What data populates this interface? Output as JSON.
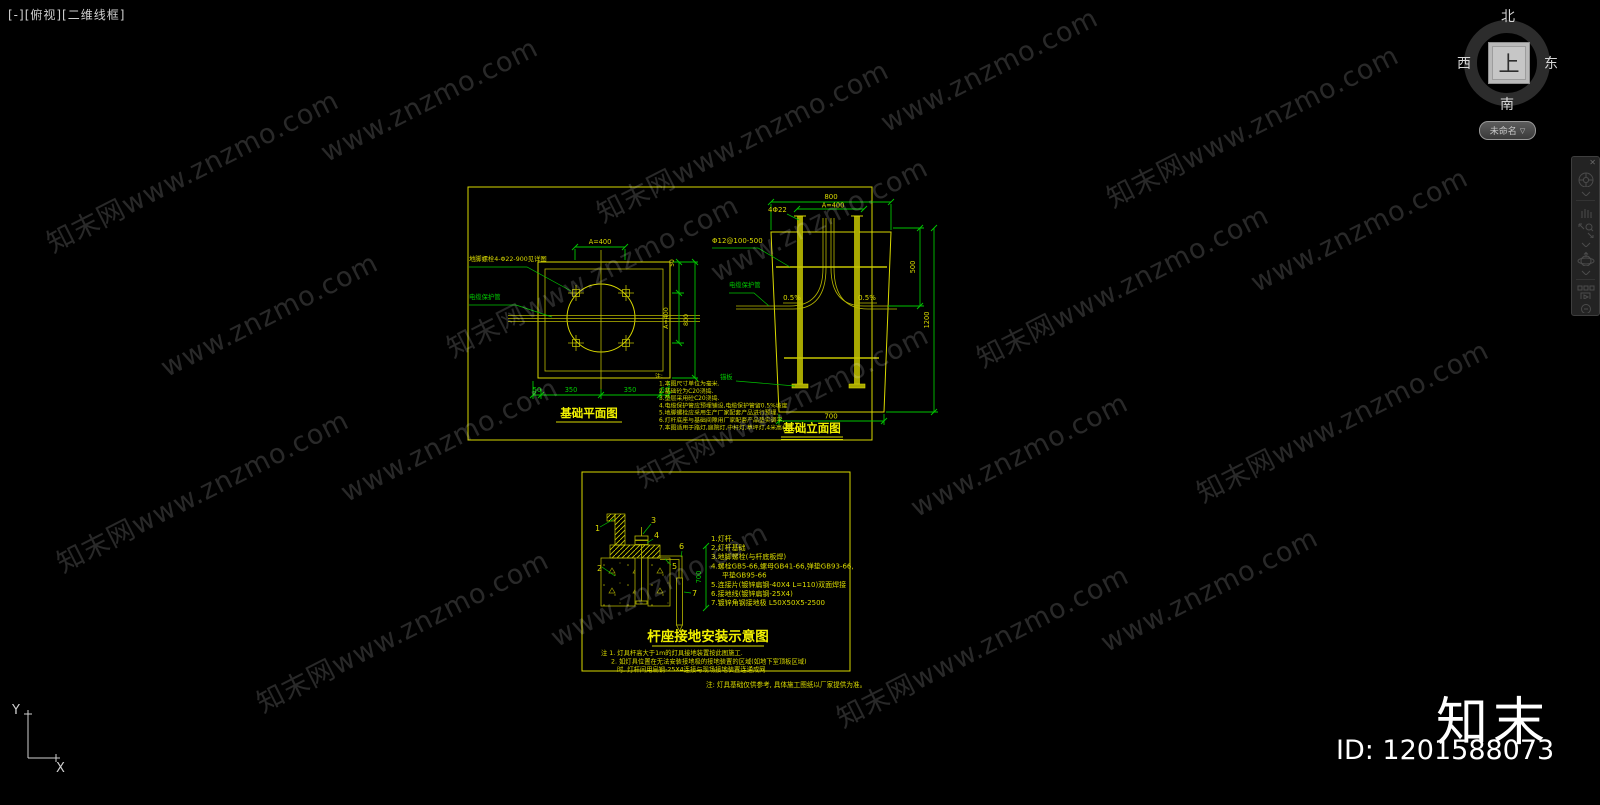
{
  "viewport": {
    "controls": "[-][俯视][二维线框]"
  },
  "viewcube": {
    "north": "北",
    "south": "南",
    "east": "东",
    "west": "西",
    "top": "上",
    "menu_label": "未命名",
    "menu_arrow": "▽"
  },
  "watermark": {
    "full": "知末网www.znzmo.com",
    "url": "www.znzmo.com"
  },
  "ucs": {
    "x_label": "X",
    "y_label": "Y"
  },
  "footer": {
    "brand": "知末",
    "id_text": "ID: 1201588073"
  },
  "colors": {
    "cad_yellow": "#d9d900",
    "dim_green": "#00c400",
    "background": "#000000"
  },
  "sheet1": {
    "plan": {
      "title": "基础平面图",
      "dim_top": "A=400",
      "dims_bottom": [
        "50",
        "350",
        "350",
        "50"
      ],
      "dim_right_top": "50",
      "dim_right_inner": "A=400",
      "dim_right_outer": "800",
      "label_bolt": "地脚螺栓4-Φ22-900见详图",
      "label_conduit": "电缆保护管"
    },
    "elevation": {
      "title": "基础立面图",
      "dim_top_outer": "800",
      "dim_top_inner": "A=400",
      "label_bolts": "4Φ22",
      "label_rebar": "Φ12@100-500",
      "label_conduit": "电缆保护管",
      "label_anchor": "锚板",
      "slope_left": "0.5%",
      "slope_right": "0.5%",
      "dim_bottom": "700",
      "dim_right_upper": "500",
      "dim_right_full": "1200"
    },
    "notes": {
      "heading": "注:",
      "lines": [
        "1.本图尺寸单位为毫米.",
        "2.基础砼为C20浇捣.",
        "3.垫层采用砼C20浇捣.",
        "4.电缆保护管应预埋铺设,电缆保护管留0.5%坡度",
        "5.地脚螺栓应采用生产厂家配套产品进行预埋.",
        "6.灯杆底座与基础间隙用厂家配套产品垫实调平.",
        "7.本图适用于路灯,庭院灯,中杆灯,草坪灯,4米高杆灯."
      ]
    }
  },
  "sheet2": {
    "title": "杆座接地安装示意图",
    "dim_depth": "700",
    "callouts": [
      "1",
      "2",
      "3",
      "4",
      "5",
      "6",
      "7"
    ],
    "items": [
      "1.灯杆.",
      "2.灯杆基础",
      "3.地脚螺栓(与杆底板焊)",
      "4.螺栓GB5-66,螺母GB41-66,弹垫GB93-66,",
      "平垫GB95-66",
      "5.连接片(镀锌扁钢-40X4 L=110)双面焊接",
      "6.接地线(镀锌扁钢-25X4)",
      "7.镀锌角钢接地极 L50X50X5-2500"
    ],
    "notes": [
      "注 1. 灯具杆高大于1m的灯具接地装置按此图施工.",
      "2. 如灯具位置在无法安装接地极的接地装置的区域(如地下室顶板区域)",
      "时, 灯杆间用扁钢-25X4连接与现场接地装置连通成网."
    ],
    "footnote": "注: 灯具基础仅供参考, 具体施工图纸以厂家提供为准。"
  }
}
